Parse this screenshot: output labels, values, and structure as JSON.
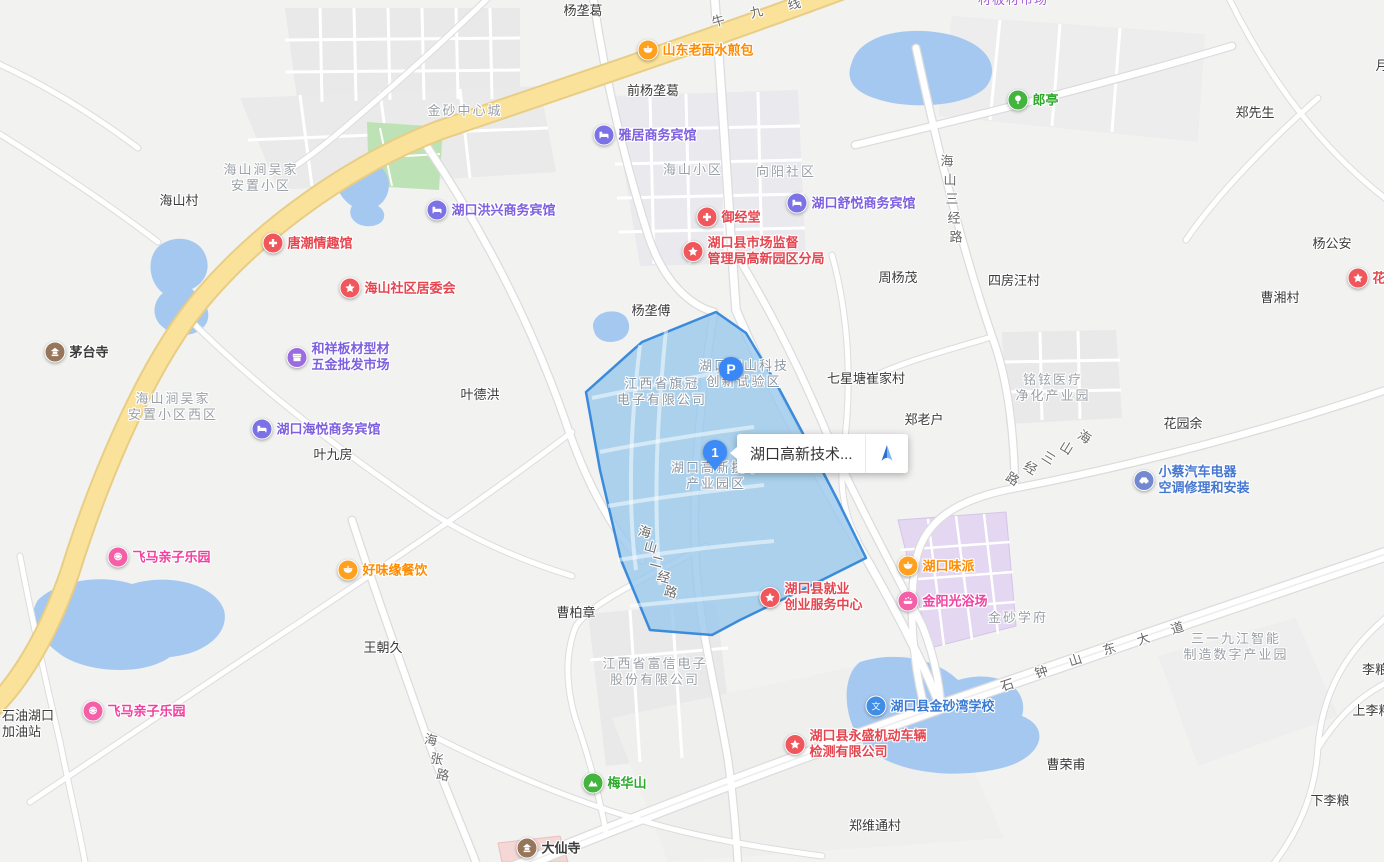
{
  "map": {
    "tooltip_text": "湖口高新技术...",
    "pin_number": "1",
    "parking_label": "P"
  },
  "colors": {
    "highlight_fill": "#99c8ec",
    "highlight_border": "#3c8bdb",
    "road_yellow": "#fbe29b",
    "water": "#a5c8f0",
    "pin_blue": "#3d8bf8",
    "park_green": "#bde2b5",
    "estate_purple": "#e3d7f1"
  },
  "pois": [
    {
      "label": [
        "山东老面水煎包"
      ],
      "x": 648,
      "y": 50,
      "icon": "food",
      "color": "orange"
    },
    {
      "label": [
        "雅居商务宾馆"
      ],
      "x": 604,
      "y": 135,
      "icon": "hotel",
      "color": "purple"
    },
    {
      "label": [
        "郎亭"
      ],
      "x": 1018,
      "y": 100,
      "icon": "tree",
      "color": "green"
    },
    {
      "label": [
        "湖口洪兴商务宾馆"
      ],
      "x": 437,
      "y": 210,
      "icon": "hotel",
      "color": "purple"
    },
    {
      "label": [
        "湖口舒悦商务宾馆"
      ],
      "x": 797,
      "y": 203,
      "icon": "hotel",
      "color": "purple"
    },
    {
      "label": [
        "御经堂"
      ],
      "x": 707,
      "y": 217,
      "icon": "cross",
      "color": "red"
    },
    {
      "label": [
        "唐潮情趣馆"
      ],
      "x": 273,
      "y": 243,
      "icon": "cross",
      "color": "red"
    },
    {
      "label": [
        "湖口县市场监督",
        "管理局高新园区分局"
      ],
      "x": 693,
      "y": 251,
      "icon": "star",
      "color": "red"
    },
    {
      "label": [
        "海山社区居委会"
      ],
      "x": 350,
      "y": 288,
      "icon": "star",
      "color": "red"
    },
    {
      "label": [
        "茅台寺"
      ],
      "x": 55,
      "y": 352,
      "icon": "temple",
      "color": "dark"
    },
    {
      "label": [
        "和祥板材型材",
        "五金批发市场"
      ],
      "x": 297,
      "y": 357,
      "icon": "shop",
      "color": "purple"
    },
    {
      "label": [
        "湖口海悦商务宾馆"
      ],
      "x": 262,
      "y": 429,
      "icon": "hotel",
      "color": "purple"
    },
    {
      "label": [
        "小蔡汽车电器",
        "空调修理和安装"
      ],
      "x": 1144,
      "y": 480,
      "icon": "car",
      "color": "blue"
    },
    {
      "label": [
        "飞马亲子乐园"
      ],
      "x": 118,
      "y": 557,
      "icon": "fun",
      "color": "pink"
    },
    {
      "label": [
        "好味缘餐饮"
      ],
      "x": 348,
      "y": 570,
      "icon": "food",
      "color": "orange"
    },
    {
      "label": [
        "湖口味派"
      ],
      "x": 908,
      "y": 566,
      "icon": "food",
      "color": "orange"
    },
    {
      "label": [
        "金阳光浴场"
      ],
      "x": 908,
      "y": 601,
      "icon": "bath",
      "color": "pink"
    },
    {
      "label": [
        "湖口县就业",
        "创业服务中心"
      ],
      "x": 770,
      "y": 597,
      "icon": "star",
      "color": "red"
    },
    {
      "label": [
        "湖口县金砂湾学校"
      ],
      "x": 876,
      "y": 706,
      "icon": "school",
      "color": "schoolblue"
    },
    {
      "label": [
        "湖口县永盛机动车辆",
        "检测有限公司"
      ],
      "x": 795,
      "y": 744,
      "icon": "star",
      "color": "red"
    },
    {
      "label": [
        "飞马亲子乐园"
      ],
      "x": 93,
      "y": 711,
      "icon": "fun",
      "color": "pink"
    },
    {
      "label": [
        "梅华山"
      ],
      "x": 593,
      "y": 783,
      "icon": "mountain",
      "color": "green"
    },
    {
      "label": [
        "大仙寺"
      ],
      "x": 527,
      "y": 848,
      "icon": "temple",
      "color": "dark"
    },
    {
      "label": [
        "花园"
      ],
      "x": 1358,
      "y": 278,
      "icon": "star",
      "color": "red"
    }
  ],
  "labels": [
    {
      "lines": [
        "杨垄葛"
      ],
      "x": 583,
      "y": 11,
      "kind": "place"
    },
    {
      "lines": [
        "前杨垄葛"
      ],
      "x": 653,
      "y": 91,
      "kind": "place"
    },
    {
      "lines": [
        "郑先生"
      ],
      "x": 1255,
      "y": 113,
      "kind": "place"
    },
    {
      "lines": [
        "海山村"
      ],
      "x": 179,
      "y": 201,
      "kind": "place"
    },
    {
      "lines": [
        "周杨茂"
      ],
      "x": 898,
      "y": 278,
      "kind": "place"
    },
    {
      "lines": [
        "四房汪村"
      ],
      "x": 1014,
      "y": 281,
      "kind": "place"
    },
    {
      "lines": [
        "杨公安"
      ],
      "x": 1332,
      "y": 244,
      "kind": "place"
    },
    {
      "lines": [
        "曹湘村"
      ],
      "x": 1280,
      "y": 298,
      "kind": "place"
    },
    {
      "lines": [
        "杨垄傅"
      ],
      "x": 651,
      "y": 311,
      "kind": "place"
    },
    {
      "lines": [
        "七星塘崔家村"
      ],
      "x": 866,
      "y": 379,
      "kind": "place"
    },
    {
      "lines": [
        "郑老户"
      ],
      "x": 924,
      "y": 420,
      "kind": "place"
    },
    {
      "lines": [
        "叶德洪"
      ],
      "x": 480,
      "y": 395,
      "kind": "place"
    },
    {
      "lines": [
        "叶九房"
      ],
      "x": 333,
      "y": 455,
      "kind": "place"
    },
    {
      "lines": [
        "花园余"
      ],
      "x": 1183,
      "y": 424,
      "kind": "place"
    },
    {
      "lines": [
        "曹柏章"
      ],
      "x": 576,
      "y": 613,
      "kind": "place"
    },
    {
      "lines": [
        "王朝久"
      ],
      "x": 383,
      "y": 648,
      "kind": "place"
    },
    {
      "lines": [
        "郑维通村"
      ],
      "x": 875,
      "y": 826,
      "kind": "place"
    },
    {
      "lines": [
        "曹荣甫"
      ],
      "x": 1066,
      "y": 765,
      "kind": "place"
    },
    {
      "lines": [
        "下李粮"
      ],
      "x": 1330,
      "y": 801,
      "kind": "place"
    },
    {
      "lines": [
        "上李粮"
      ],
      "x": 1372,
      "y": 711,
      "kind": "place"
    },
    {
      "lines": [
        "李粮"
      ],
      "x": 1375,
      "y": 670,
      "kind": "place"
    },
    {
      "lines": [
        "月"
      ],
      "x": 1382,
      "y": 66,
      "kind": "place"
    },
    {
      "lines": [
        "石油湖口",
        "加油站"
      ],
      "x": 2,
      "y": 724,
      "kind": "place",
      "align": "left"
    },
    {
      "lines": [
        "金砂中心城"
      ],
      "x": 465,
      "y": 111,
      "kind": "area"
    },
    {
      "lines": [
        "海山涧吴家",
        "安置小区"
      ],
      "x": 261,
      "y": 178,
      "kind": "area"
    },
    {
      "lines": [
        "海山小区"
      ],
      "x": 693,
      "y": 170,
      "kind": "area"
    },
    {
      "lines": [
        "向阳社区"
      ],
      "x": 786,
      "y": 172,
      "kind": "area"
    },
    {
      "lines": [
        "海山涧吴家",
        "安置小区西区"
      ],
      "x": 173,
      "y": 407,
      "kind": "area"
    },
    {
      "lines": [
        "铭铉医疗",
        "净化产业园"
      ],
      "x": 1053,
      "y": 388,
      "kind": "area"
    },
    {
      "lines": [
        "金砂学府"
      ],
      "x": 1018,
      "y": 618,
      "kind": "area"
    },
    {
      "lines": [
        "三一九江智能",
        "制造数字产业园"
      ],
      "x": 1236,
      "y": 647,
      "kind": "area"
    },
    {
      "lines": [
        "江西省富信电子",
        "股份有限公司"
      ],
      "x": 655,
      "y": 672,
      "kind": "area"
    },
    {
      "lines": [
        "江西省旗冠",
        "电子有限公司"
      ],
      "x": 662,
      "y": 392,
      "kind": "bluearea"
    },
    {
      "lines": [
        "湖口海山科技",
        "创新试验区"
      ],
      "x": 744,
      "y": 374,
      "kind": "bluearea"
    },
    {
      "lines": [
        "湖口高新技术",
        "产业园区"
      ],
      "x": 716,
      "y": 476,
      "kind": "bluearea"
    },
    {
      "lines": [
        "材板材市场"
      ],
      "x": 1013,
      "y": 0,
      "kind": "purple"
    }
  ],
  "road_labels": [
    {
      "name": "牛九线",
      "chars": [
        {
          "c": "牛",
          "x": 718,
          "y": 20,
          "r": -16
        },
        {
          "c": "九",
          "x": 756,
          "y": 11,
          "r": -16
        },
        {
          "c": "线",
          "x": 794,
          "y": 3,
          "r": -14
        }
      ]
    },
    {
      "name": "海山三经路",
      "chars": [
        {
          "c": "海",
          "x": 947,
          "y": 160,
          "r": 0
        },
        {
          "c": "山",
          "x": 950,
          "y": 179,
          "r": 0
        },
        {
          "c": "三",
          "x": 952,
          "y": 198,
          "r": 0
        },
        {
          "c": "经",
          "x": 954,
          "y": 217,
          "r": 0
        },
        {
          "c": "路",
          "x": 956,
          "y": 236,
          "r": 0
        }
      ]
    },
    {
      "name": "海山三经路",
      "chars": [
        {
          "c": "海",
          "x": 1085,
          "y": 436,
          "r": 32
        },
        {
          "c": "山",
          "x": 1067,
          "y": 447,
          "r": 32
        },
        {
          "c": "三",
          "x": 1049,
          "y": 457,
          "r": 32
        },
        {
          "c": "经",
          "x": 1031,
          "y": 467,
          "r": 32
        },
        {
          "c": "路",
          "x": 1013,
          "y": 478,
          "r": 32
        }
      ]
    },
    {
      "name": "海山二经路",
      "chars": [
        {
          "c": "海",
          "x": 645,
          "y": 531,
          "r": 15
        },
        {
          "c": "山",
          "x": 651,
          "y": 546,
          "r": 15
        },
        {
          "c": "二",
          "x": 657,
          "y": 561,
          "r": 15
        },
        {
          "c": "经",
          "x": 664,
          "y": 576,
          "r": 15
        },
        {
          "c": "路",
          "x": 671,
          "y": 591,
          "r": 15
        }
      ]
    },
    {
      "name": "石钟山东大道",
      "chars": [
        {
          "c": "石",
          "x": 1007,
          "y": 684,
          "r": -18
        },
        {
          "c": "钟",
          "x": 1041,
          "y": 671,
          "r": -18
        },
        {
          "c": "山",
          "x": 1075,
          "y": 659,
          "r": -18
        },
        {
          "c": "东",
          "x": 1109,
          "y": 648,
          "r": -18
        },
        {
          "c": "大",
          "x": 1143,
          "y": 638,
          "r": -18
        },
        {
          "c": "道",
          "x": 1177,
          "y": 627,
          "r": -18
        }
      ]
    },
    {
      "name": "海张路",
      "chars": [
        {
          "c": "海",
          "x": 431,
          "y": 739,
          "r": 10
        },
        {
          "c": "张",
          "x": 437,
          "y": 758,
          "r": 10
        },
        {
          "c": "路",
          "x": 443,
          "y": 774,
          "r": 10
        }
      ]
    }
  ]
}
